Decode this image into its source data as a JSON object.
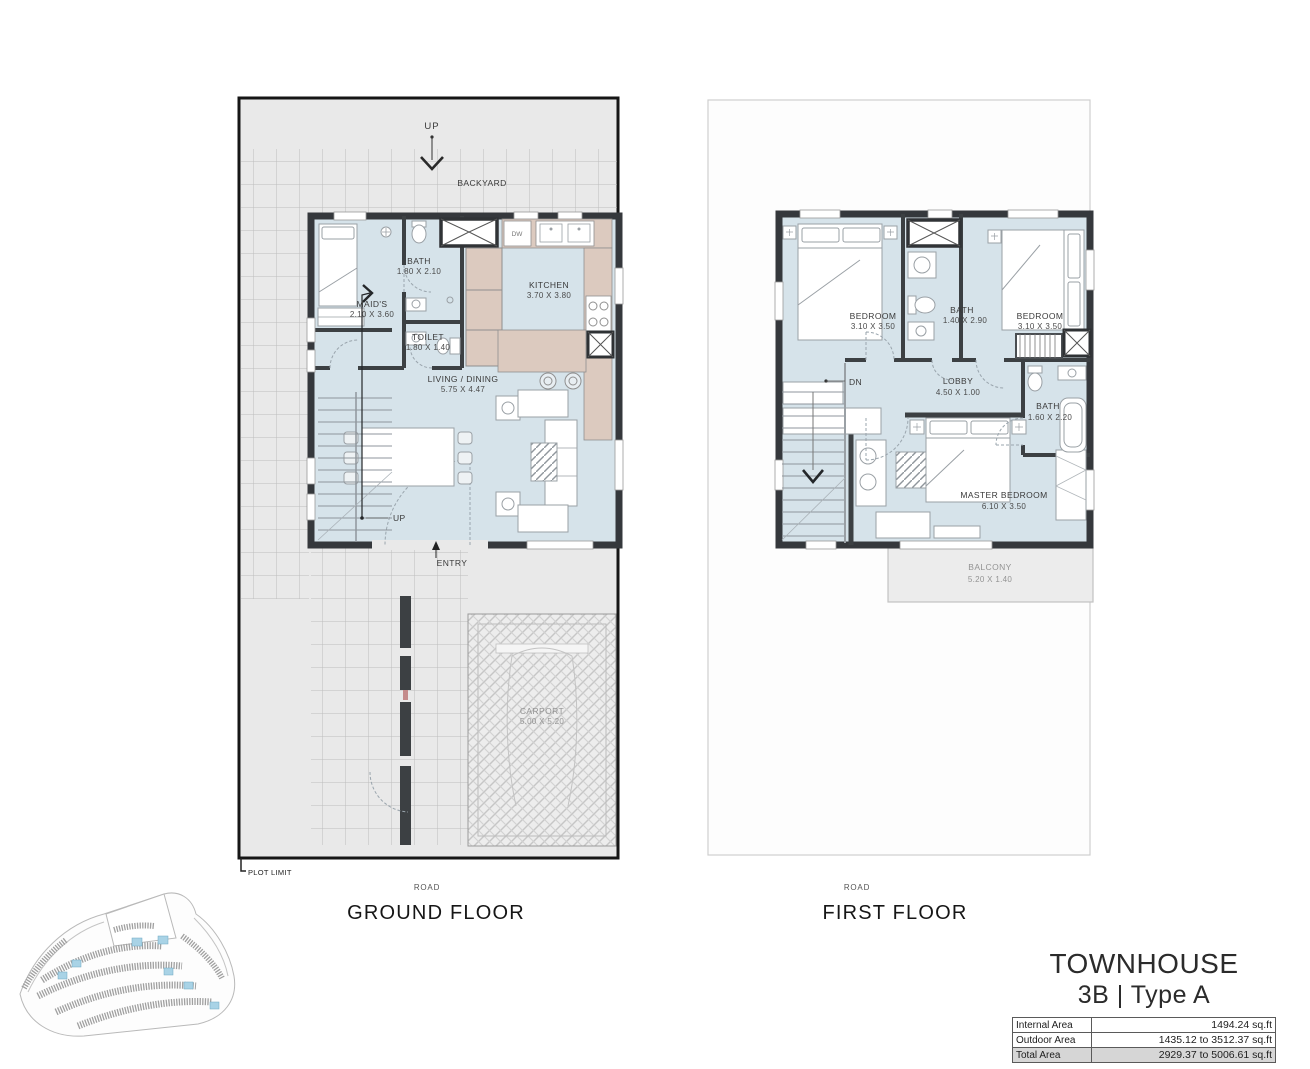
{
  "colors": {
    "room_fill": "#d6e3ea",
    "wall": "#35383c",
    "outdoor_gray": "#e9e9e9",
    "counter_tan": "#dccabf",
    "site_highlight_blue": "#a9d3e6",
    "table_total_row": "#d6d6d6"
  },
  "ground_floor": {
    "title": "GROUND FLOOR",
    "road_label": "ROAD",
    "labels": {
      "up_top": "UP",
      "backyard": "BACKYARD",
      "entry": "ENTRY",
      "stairs_up": "UP",
      "plot_limit": "PLOT LIMIT",
      "dw": "DW"
    },
    "rooms": [
      {
        "name": "MAID'S",
        "dims": "2.10 X 3.60"
      },
      {
        "name": "BATH",
        "dims": "1.80 X 2.10"
      },
      {
        "name": "TOILET",
        "dims": "1.80 X 1.40"
      },
      {
        "name": "KITCHEN",
        "dims": "3.70 X 3.80"
      },
      {
        "name": "LIVING / DINING",
        "dims": "5.75 X 4.47"
      },
      {
        "name": "CARPORT",
        "dims": "5.00 X 5.20"
      }
    ]
  },
  "first_floor": {
    "title": "FIRST FLOOR",
    "road_label": "ROAD",
    "labels": {
      "dn": "DN"
    },
    "rooms": [
      {
        "name": "BEDROOM",
        "dims": "3.10 X 3.50"
      },
      {
        "name": "BATH",
        "dims": "1.40 X 2.90"
      },
      {
        "name": "BEDROOM",
        "dims": "3.10 X 3.50"
      },
      {
        "name": "LOBBY",
        "dims": "4.50 X 1.00"
      },
      {
        "name": "BATH",
        "dims": "1.60 X 2.20"
      },
      {
        "name": "MASTER BEDROOM",
        "dims": "6.10 X 3.50"
      },
      {
        "name": "BALCONY",
        "dims": "5.20 X 1.40"
      }
    ]
  },
  "title_block": {
    "line1": "TOWNHOUSE",
    "line2": "3B | Type A",
    "table": [
      {
        "label": "Internal Area",
        "value": "1494.24 sq.ft"
      },
      {
        "label": "Outdoor Area",
        "value": "1435.12 to 3512.37 sq.ft"
      },
      {
        "label": "Total Area",
        "value": "2929.37 to 5006.61 sq.ft"
      }
    ]
  }
}
